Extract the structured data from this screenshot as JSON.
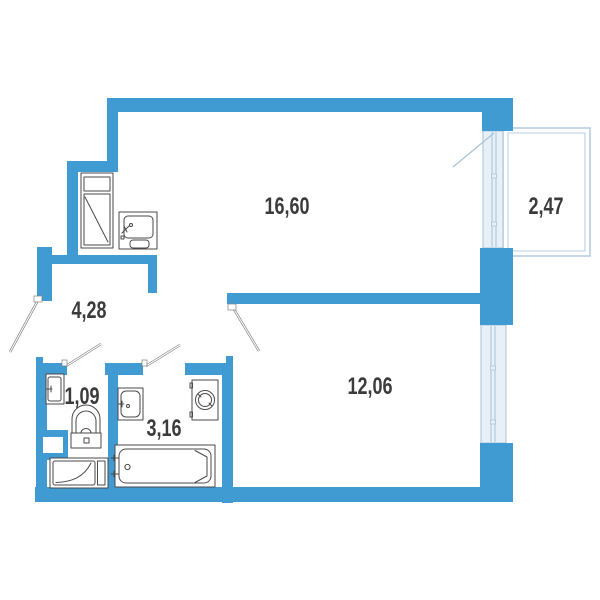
{
  "plan": {
    "rooms": [
      {
        "id": "living-kitchen",
        "area_label": "16,60"
      },
      {
        "id": "balcony",
        "area_label": "2,47"
      },
      {
        "id": "hallway",
        "area_label": "4,28"
      },
      {
        "id": "wc",
        "area_label": "1,09"
      },
      {
        "id": "bathroom",
        "area_label": "3,16"
      },
      {
        "id": "bedroom",
        "area_label": "12,06"
      }
    ],
    "colors": {
      "wall": "#3F9BD1",
      "window_fill": "#E8F0F7",
      "window_stroke": "#A7C3D9",
      "balcony_stroke": "#B7CFE2",
      "fixture_stroke": "#4A4A4A",
      "label_text": "#3B3B3B"
    }
  }
}
